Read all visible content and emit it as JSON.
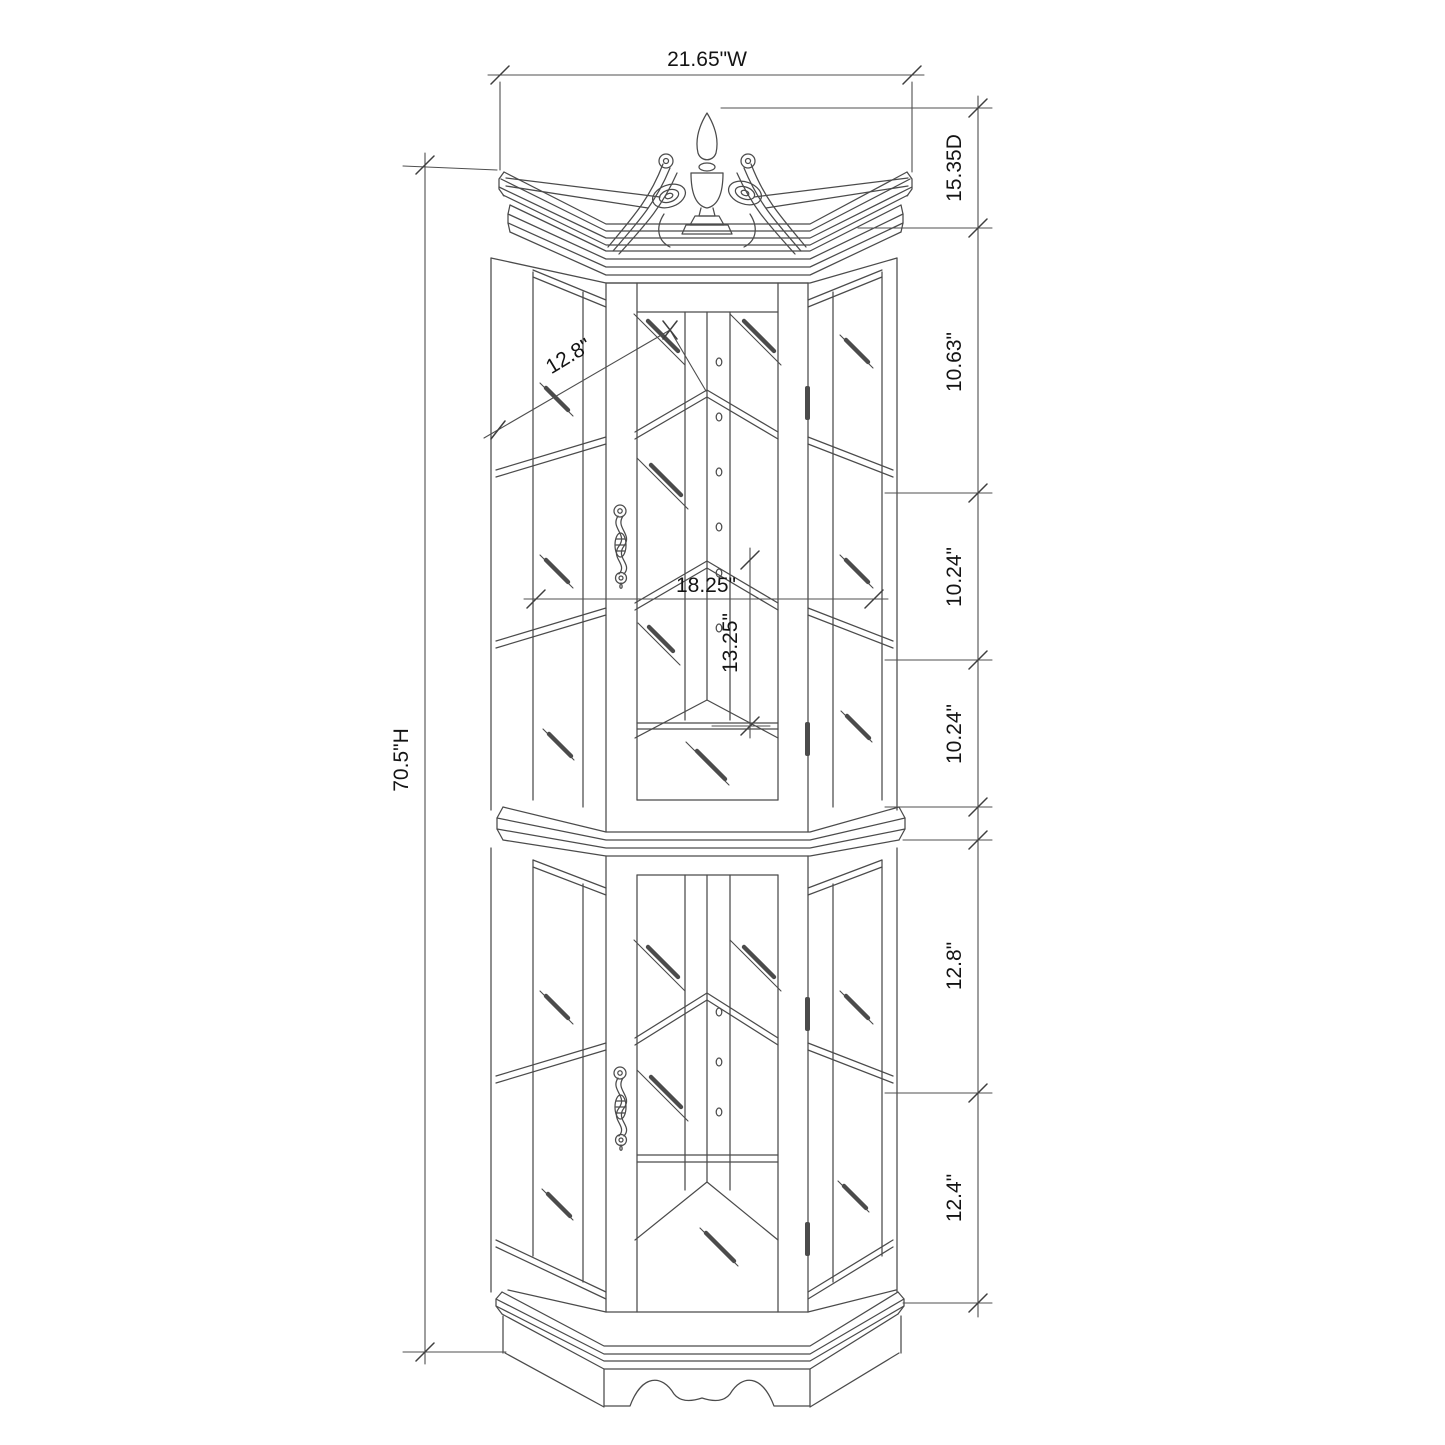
{
  "page": {
    "background": "#ffffff",
    "line_color": "#4b4b4b",
    "text_color": "#141414"
  },
  "drawing": {
    "subject": "corner curio display cabinet dimensioned elevation",
    "overall_width": "21.65\"W",
    "overall_depth": "15.35D",
    "overall_height": "70.5\"H",
    "upper_shelf_diagonal": "12.8\"",
    "interior_width": "18.25\"",
    "upper_glass_height": "13.25\"",
    "right_segments": [
      "10.63\"",
      "10.24\"",
      "10.24\"",
      "12.8\"",
      "12.4\""
    ]
  }
}
